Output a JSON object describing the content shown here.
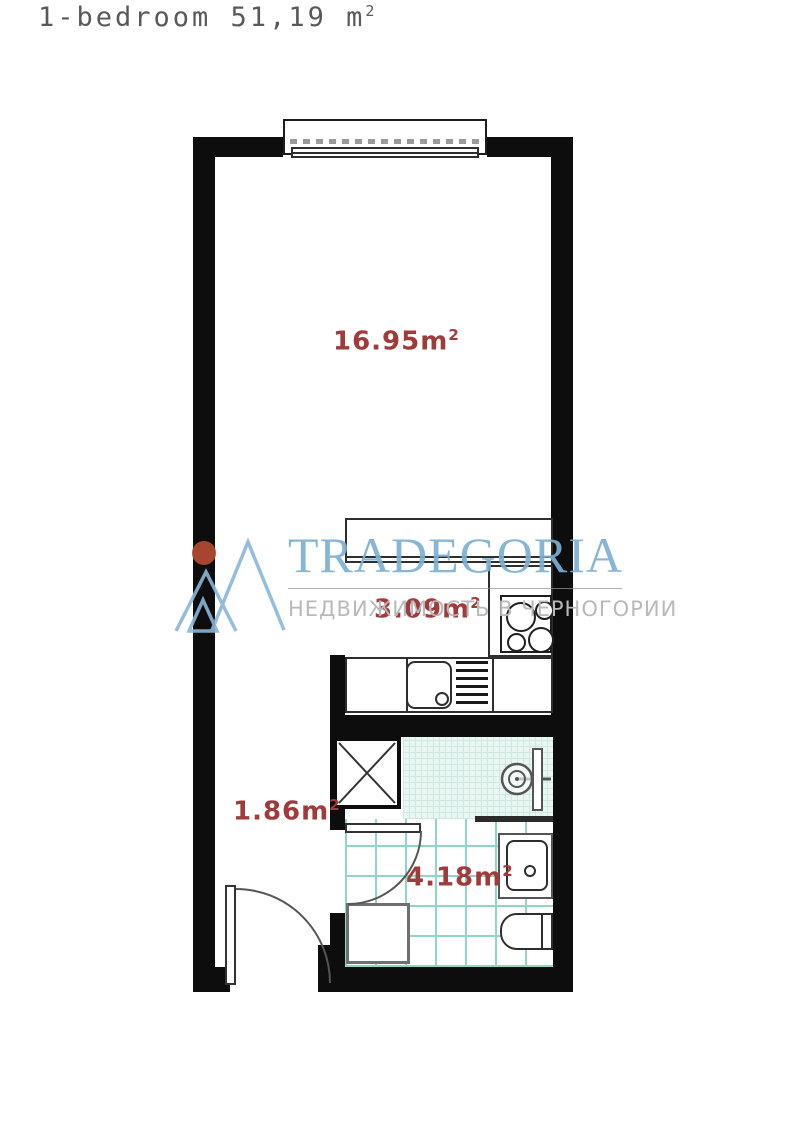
{
  "title": {
    "text": "1-bedroom 51,19 m",
    "sup": "2"
  },
  "watermark": {
    "brand": "TRADEGORIA",
    "tagline": "НЕДВИЖИМОСТЬ В ЧЕРНОГОРИИ",
    "brand_color": "#7dafd3",
    "tagline_color": "#b7babc",
    "logo_dot_color": "#b04a30",
    "logo_line_color": "#8ab6d8"
  },
  "floorplan": {
    "label_color": "#a23a3a",
    "wall_color": "#0d0d0d",
    "tile_line_color": "#8ed6c8",
    "rooms": [
      {
        "name": "living-room",
        "label": "16.95m",
        "sup": "2"
      },
      {
        "name": "kitchen",
        "label": "3.09m",
        "sup": "2"
      },
      {
        "name": "hallway",
        "label": "1.86m",
        "sup": "2"
      },
      {
        "name": "bathroom",
        "label": "4.18m",
        "sup": "2"
      }
    ]
  }
}
